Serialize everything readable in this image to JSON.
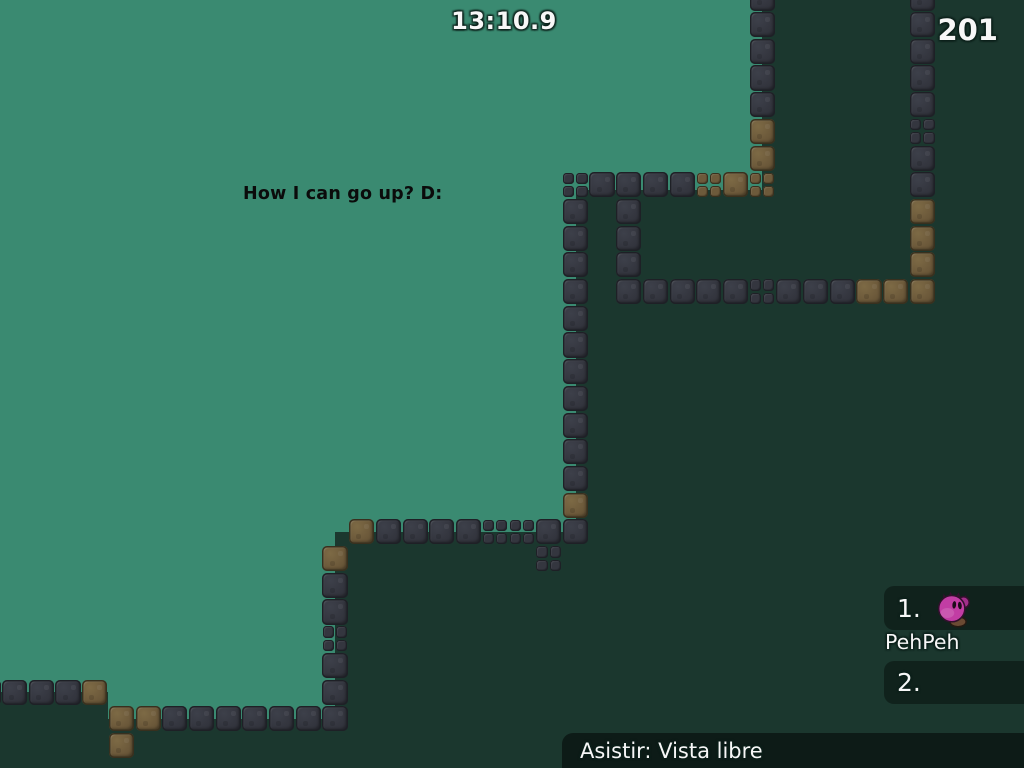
{
  "hud": {
    "timer": "13:10.9",
    "counter": "201",
    "broadcast": "How I can go up? D:"
  },
  "leaderboard": {
    "entries": [
      {
        "rank": "1.",
        "player": "PehPeh",
        "has_avatar": true
      },
      {
        "rank": "2.",
        "player": "",
        "has_avatar": false
      }
    ]
  },
  "spectate": {
    "label": "Asistir: Vista libre"
  },
  "colors": {
    "bg_light": "#3a8a71",
    "bg_dark": "#1b372e",
    "tile_dark": "#34363f",
    "tile_brown": "#6d5a3b",
    "tee_body": "#c23da4",
    "tee_ear": "#a22e8a",
    "tee_outline": "#33102d",
    "tee_foot": "#6b4a33",
    "text_white": "#f7f7f7",
    "broadcast_text": "#0b0b0b"
  },
  "map": {
    "tile_size": 26.7,
    "offset_x": 2,
    "offset_y": 12,
    "tile_types": {
      "d": "dark-block",
      "b": "brown-block",
      "s": "small-dark-2x2",
      "sb": "small-brown-2x2"
    },
    "tiles": [
      [
        34,
        -1,
        "d"
      ],
      [
        34,
        0,
        "d"
      ],
      [
        34,
        1,
        "d"
      ],
      [
        34,
        2,
        "d"
      ],
      [
        34,
        3,
        "d"
      ],
      [
        34,
        4,
        "s"
      ],
      [
        34,
        5,
        "d"
      ],
      [
        34,
        6,
        "d"
      ],
      [
        34,
        7,
        "b"
      ],
      [
        34,
        8,
        "b"
      ],
      [
        34,
        9,
        "b"
      ],
      [
        28,
        -1,
        "d"
      ],
      [
        28,
        0,
        "d"
      ],
      [
        28,
        1,
        "d"
      ],
      [
        28,
        2,
        "d"
      ],
      [
        28,
        3,
        "d"
      ],
      [
        28,
        4,
        "b"
      ],
      [
        28,
        5,
        "b"
      ],
      [
        21,
        6,
        "s"
      ],
      [
        22,
        6,
        "d"
      ],
      [
        23,
        6,
        "d"
      ],
      [
        24,
        6,
        "d"
      ],
      [
        25,
        6,
        "d"
      ],
      [
        26,
        6,
        "sb"
      ],
      [
        27,
        6,
        "b"
      ],
      [
        28,
        6,
        "sb"
      ],
      [
        23,
        7,
        "d"
      ],
      [
        23,
        8,
        "d"
      ],
      [
        23,
        9,
        "d"
      ],
      [
        23,
        10,
        "d"
      ],
      [
        24,
        10,
        "d"
      ],
      [
        25,
        10,
        "d"
      ],
      [
        26,
        10,
        "d"
      ],
      [
        27,
        10,
        "d"
      ],
      [
        28,
        10,
        "s"
      ],
      [
        29,
        10,
        "d"
      ],
      [
        30,
        10,
        "d"
      ],
      [
        31,
        10,
        "d"
      ],
      [
        32,
        10,
        "b"
      ],
      [
        33,
        10,
        "b"
      ],
      [
        34,
        10,
        "b"
      ],
      [
        21,
        7,
        "d"
      ],
      [
        21,
        8,
        "d"
      ],
      [
        21,
        9,
        "d"
      ],
      [
        21,
        10,
        "d"
      ],
      [
        21,
        11,
        "d"
      ],
      [
        21,
        12,
        "d"
      ],
      [
        21,
        13,
        "d"
      ],
      [
        21,
        14,
        "d"
      ],
      [
        21,
        15,
        "d"
      ],
      [
        21,
        16,
        "d"
      ],
      [
        21,
        17,
        "d"
      ],
      [
        21,
        18,
        "b"
      ],
      [
        13,
        19,
        "b"
      ],
      [
        14,
        19,
        "d"
      ],
      [
        15,
        19,
        "d"
      ],
      [
        16,
        19,
        "d"
      ],
      [
        17,
        19,
        "d"
      ],
      [
        18,
        19,
        "s"
      ],
      [
        19,
        19,
        "s"
      ],
      [
        20,
        19,
        "d"
      ],
      [
        21,
        19,
        "d"
      ],
      [
        20,
        20,
        "s"
      ],
      [
        12,
        20,
        "b"
      ],
      [
        12,
        21,
        "d"
      ],
      [
        12,
        22,
        "d"
      ],
      [
        12,
        23,
        "s"
      ],
      [
        12,
        24,
        "d"
      ],
      [
        12,
        25,
        "d"
      ],
      [
        12,
        26,
        "d"
      ],
      [
        -1,
        25,
        "d"
      ],
      [
        0,
        25,
        "d"
      ],
      [
        1,
        25,
        "d"
      ],
      [
        2,
        25,
        "d"
      ],
      [
        3,
        25,
        "b"
      ],
      [
        4,
        26,
        "b"
      ],
      [
        5,
        26,
        "b"
      ],
      [
        6,
        26,
        "d"
      ],
      [
        7,
        26,
        "d"
      ],
      [
        8,
        26,
        "d"
      ],
      [
        9,
        26,
        "d"
      ],
      [
        10,
        26,
        "d"
      ],
      [
        11,
        26,
        "d"
      ],
      [
        4,
        27,
        "b"
      ]
    ],
    "light_region_polygon": [
      [
        0,
        0
      ],
      [
        762,
        0
      ],
      [
        762,
        190
      ],
      [
        576,
        190
      ],
      [
        576,
        532
      ],
      [
        335,
        532
      ],
      [
        335,
        719
      ],
      [
        108,
        719
      ],
      [
        108,
        692
      ],
      [
        0,
        692
      ]
    ]
  }
}
